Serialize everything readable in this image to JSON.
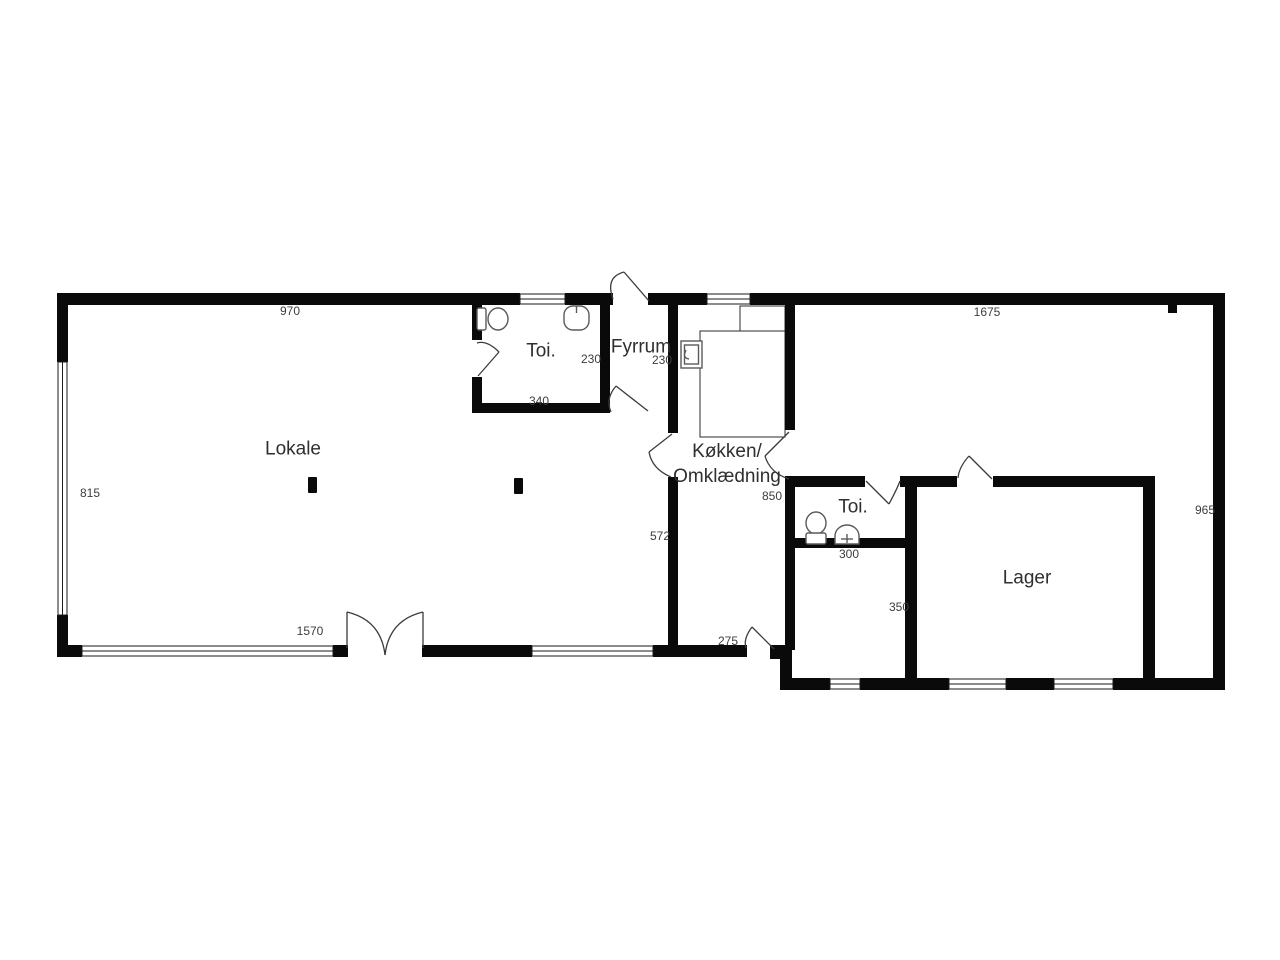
{
  "title": "Floor plan",
  "rooms": {
    "lokale": "Lokale",
    "toi1": "Toi.",
    "fyrrum": "Fyrrum",
    "kitchen_line1": "Køkken/",
    "kitchen_line2": "Omklædning",
    "toi2": "Toi.",
    "lager": "Lager"
  },
  "dims": {
    "top_left": "970",
    "top_right": "1675",
    "left_side": "815",
    "right_side": "965",
    "toi1_depth": "230",
    "fyrrum_depth": "230",
    "toi1_width": "340",
    "kitchen_depth": "850",
    "lokale_wall": "572",
    "front_window": "1570",
    "back_door": "275",
    "toi2_width": "300",
    "hall_width": "350"
  },
  "colors": {
    "wall": "#0a0a0a",
    "background": "#ffffff",
    "text": "#2f2f2f"
  },
  "icons": [
    "toilet-icon",
    "sink-icon",
    "water-heater-icon",
    "door-swing-icon",
    "window-icon",
    "column-icon"
  ]
}
